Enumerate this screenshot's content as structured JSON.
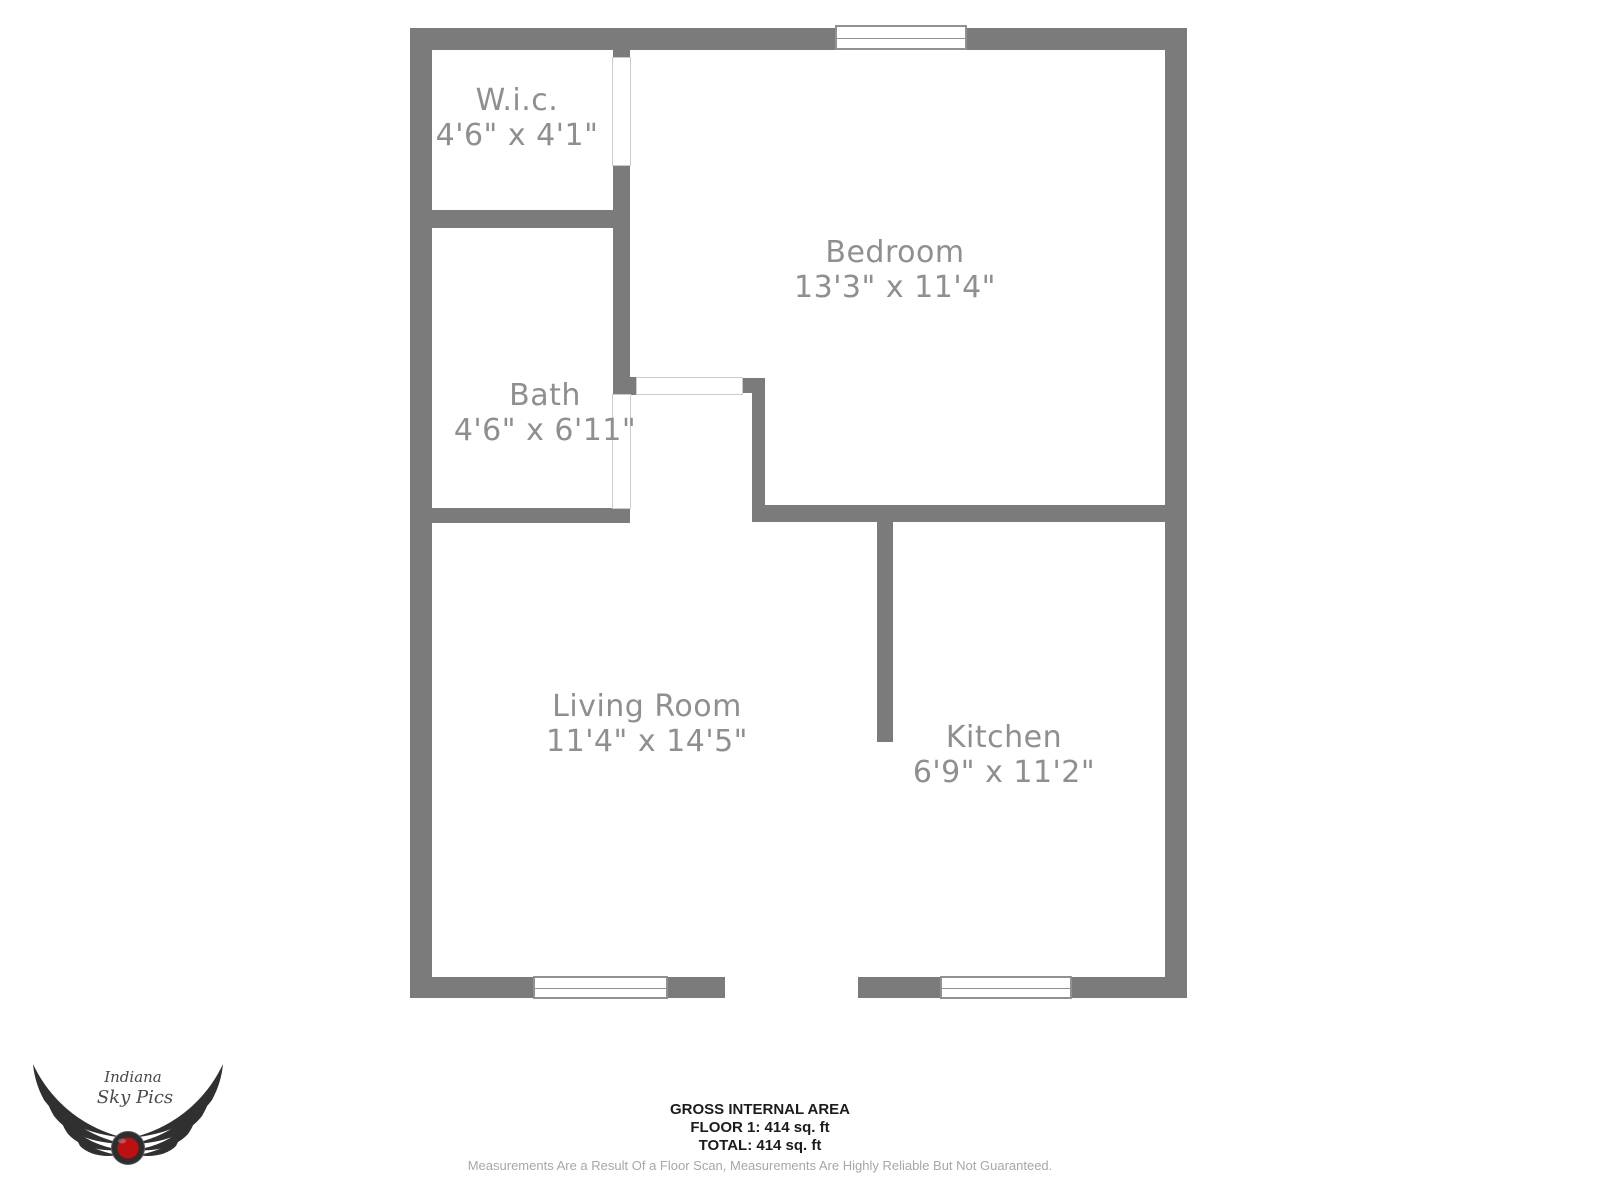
{
  "rooms": [
    {
      "id": "wic",
      "name": "W.i.c.",
      "dims": "4'6\" x 4'1\""
    },
    {
      "id": "bath",
      "name": "Bath",
      "dims": "4'6\" x 6'11\""
    },
    {
      "id": "bedroom",
      "name": "Bedroom",
      "dims": "13'3\" x 11'4\""
    },
    {
      "id": "living",
      "name": "Living Room",
      "dims": "11'4\" x 14'5\""
    },
    {
      "id": "kitchen",
      "name": "Kitchen",
      "dims": "6'9\" x 11'2\""
    }
  ],
  "footer": {
    "title": "GROSS INTERNAL AREA",
    "floor_line": "FLOOR 1: 414 sq. ft",
    "total_line": "TOTAL: 414 sq. ft",
    "disclaimer": "Measurements Are a Result Of a Floor Scan, Measurements Are Highly Reliable But Not Guaranteed."
  },
  "logo": {
    "line1": "Indiana",
    "line2": "Sky Pics"
  },
  "colors": {
    "background": "#ffffff",
    "wall": "#7b7b7b",
    "room_label": "#8f8f8f",
    "opening_outline": "#cccccc",
    "window_outline": "#919191",
    "footer_text": "#1c1c1c",
    "disclaimer_text": "#a7a7a7",
    "logo_dark": "#2e2e2e",
    "logo_red": "#bd1111"
  }
}
